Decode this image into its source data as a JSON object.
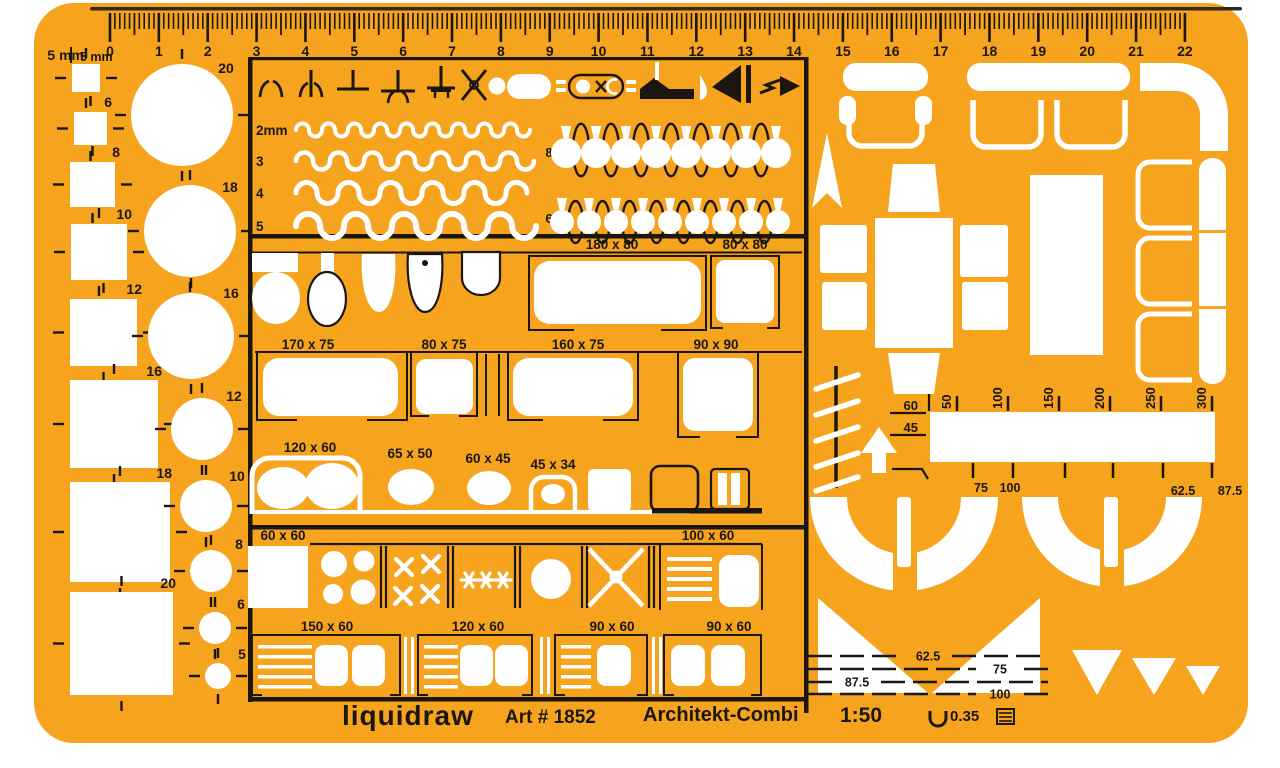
{
  "meta": {
    "description": "architectural drafting template stencil, plastic, furniture symbols"
  },
  "colors": {
    "orange": "#F6A41E",
    "black": "#1B1710",
    "white": "#FFFFFF",
    "edge": "#2E2A1C"
  },
  "footer": {
    "brand": "liquidraw",
    "art_no": "Art # 1852",
    "product_name": "Architekt-Combi",
    "scale_ratio": "1:50",
    "pen_width": "0.35"
  },
  "ruler": {
    "mm_label": "5 mm",
    "numbers": [
      "0",
      "1",
      "2",
      "3",
      "4",
      "5",
      "6",
      "7",
      "8",
      "9",
      "10",
      "11",
      "12",
      "13",
      "14",
      "15",
      "16",
      "17",
      "18",
      "19",
      "20",
      "21",
      "22"
    ]
  },
  "squares": [
    {
      "label": "5 mm",
      "x": 72,
      "y": 64,
      "s": 28,
      "lx": 84,
      "ly": 60
    },
    {
      "label": "6",
      "x": 74,
      "y": 112,
      "s": 33,
      "lx": 112,
      "ly": 107
    },
    {
      "label": "8",
      "x": 70,
      "y": 162,
      "s": 45,
      "lx": 120,
      "ly": 157
    },
    {
      "label": "10",
      "x": 71,
      "y": 224,
      "s": 56,
      "lx": 132,
      "ly": 219
    },
    {
      "label": "12",
      "x": 70,
      "y": 299,
      "s": 67,
      "lx": 142,
      "ly": 294
    },
    {
      "label": "16",
      "x": 70,
      "y": 380,
      "s": 88,
      "lx": 162,
      "ly": 376
    },
    {
      "label": "18",
      "x": 70,
      "y": 482,
      "s": 100,
      "lx": 172,
      "ly": 478
    },
    {
      "label": "20",
      "x": 70,
      "y": 592,
      "s": 103,
      "lx": 176,
      "ly": 588
    }
  ],
  "circles": [
    {
      "label": "20",
      "cx": 182,
      "cy": 115,
      "r": 51,
      "lx": 226,
      "ly": 73
    },
    {
      "label": "18",
      "cx": 190,
      "cy": 231,
      "r": 46,
      "lx": 230,
      "ly": 192
    },
    {
      "label": "16",
      "cx": 191,
      "cy": 336,
      "r": 43,
      "lx": 231,
      "ly": 298
    },
    {
      "label": "12",
      "cx": 202,
      "cy": 429,
      "r": 31,
      "lx": 234,
      "ly": 401
    },
    {
      "label": "10",
      "cx": 206,
      "cy": 506,
      "r": 26,
      "lx": 237,
      "ly": 481
    },
    {
      "label": "8",
      "cx": 211,
      "cy": 571,
      "r": 21,
      "lx": 239,
      "ly": 549
    },
    {
      "label": "6",
      "cx": 215,
      "cy": 628,
      "r": 16,
      "lx": 241,
      "ly": 609
    },
    {
      "label": "5",
      "cx": 218,
      "cy": 676,
      "r": 13,
      "lx": 242,
      "ly": 659
    }
  ],
  "wave_rows": [
    {
      "label": "2mm",
      "y": 130,
      "r": 6.5,
      "sw": 4,
      "count": 18
    },
    {
      "label": "3",
      "y": 161,
      "r": 8.5,
      "sw": 4.5,
      "count": 14
    },
    {
      "label": "4",
      "y": 193,
      "r": 10.5,
      "sw": 5,
      "count": 11
    },
    {
      "label": "5",
      "y": 226,
      "r": 12,
      "sw": 6,
      "count": 10
    }
  ],
  "hook_rows": [
    {
      "label": "8",
      "count": 8,
      "x0": 566,
      "step": 30,
      "top": 126,
      "bulb_r": 15,
      "label_y": 152
    },
    {
      "label": "6",
      "count": 9,
      "x0": 562,
      "step": 27,
      "top": 198,
      "bulb_r": 12,
      "label_y": 218
    }
  ],
  "dimension_labels": [
    {
      "text": "180 x 80",
      "x": 612,
      "y": 249
    },
    {
      "text": "80 x 80",
      "x": 745,
      "y": 249
    },
    {
      "text": "170 x 75",
      "x": 308,
      "y": 349
    },
    {
      "text": "80 x 75",
      "x": 444,
      "y": 349
    },
    {
      "text": "160 x 75",
      "x": 578,
      "y": 349
    },
    {
      "text": "90 x 90",
      "x": 716,
      "y": 349
    },
    {
      "text": "120 x 60",
      "x": 310,
      "y": 452
    },
    {
      "text": "65 x 50",
      "x": 410,
      "y": 458
    },
    {
      "text": "60 x 45",
      "x": 488,
      "y": 463
    },
    {
      "text": "45 x 34",
      "x": 553,
      "y": 469
    },
    {
      "text": "60 x 60",
      "x": 283,
      "y": 540
    },
    {
      "text": "100 x 60",
      "x": 708,
      "y": 540
    },
    {
      "text": "150 x 60",
      "x": 327,
      "y": 631
    },
    {
      "text": "120 x 60",
      "x": 478,
      "y": 631
    },
    {
      "text": "90 x 60",
      "x": 612,
      "y": 631
    },
    {
      "text": "90 x 60",
      "x": 729,
      "y": 631
    }
  ],
  "scales": {
    "top": [
      {
        "label": "50",
        "x": 957
      },
      {
        "label": "100",
        "x": 1008
      },
      {
        "label": "150",
        "x": 1059
      },
      {
        "label": "200",
        "x": 1110
      },
      {
        "label": "250",
        "x": 1161
      },
      {
        "label": "300",
        "x": 1212
      }
    ],
    "left": [
      {
        "label": "60",
        "x": 918,
        "y": 410
      },
      {
        "label": "45",
        "x": 918,
        "y": 432
      }
    ],
    "bottom_labels": [
      {
        "label": "75",
        "x": 981,
        "y": 492
      },
      {
        "label": "100",
        "x": 1010,
        "y": 492
      },
      {
        "label": "62.5",
        "x": 1183,
        "y": 495
      },
      {
        "label": "87.5",
        "x": 1230,
        "y": 495
      }
    ],
    "bottom_ticks": [
      973,
      1013,
      1065,
      1113,
      1163,
      1212
    ],
    "stair_lines": [
      {
        "label": "62.5",
        "y": 656,
        "label_x": 928
      },
      {
        "label": "75",
        "y": 669,
        "label_x": 1000
      },
      {
        "label": "87.5",
        "y": 682,
        "label_x": 857
      },
      {
        "label": "100",
        "y": 694,
        "label_x": 1000
      }
    ]
  }
}
